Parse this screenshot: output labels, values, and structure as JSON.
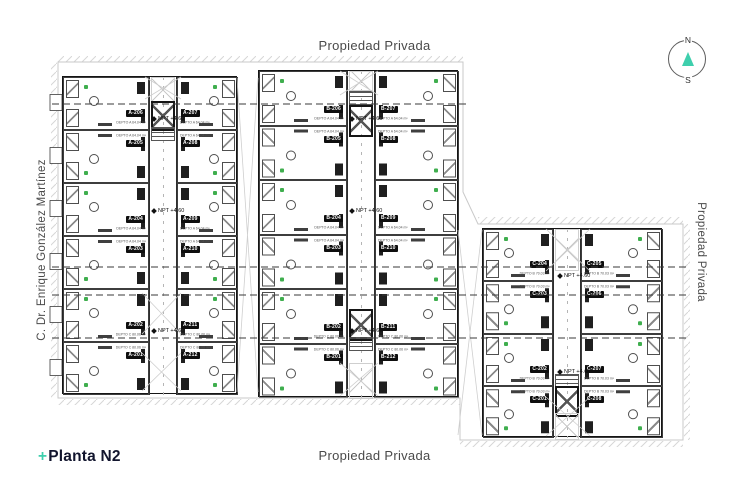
{
  "page": {
    "top_label": "Propiedad Privada",
    "bottom_label": "Propiedad Privada",
    "right_label": "Propiedad Privada",
    "left_label": "C. Dr. Enrique González Martínez",
    "title_plus": "+",
    "title": "Planta N2",
    "accent_color": "#3ECFAD",
    "title_color": "#12152E",
    "label_color": "#4A4A4A",
    "plan_line_color": "#2E2E2E",
    "vegetation_color": "#3FAE4E"
  },
  "compass": {
    "north": "N",
    "south": "S",
    "needle_color": "#3ECFAD"
  },
  "plan": {
    "level_label": "NPT +4.60",
    "blocks": [
      {
        "id": "a",
        "left_units": [
          {
            "label": "A-206",
            "area": "DEPTO A 64.04 m²"
          },
          {
            "label": "A-205",
            "area": "DEPTO A 64.04 m²"
          },
          {
            "label": "A-204",
            "area": "DEPTO A 64.04 m²"
          },
          {
            "label": "A-203",
            "area": "DEPTO A 64.04 m²"
          },
          {
            "label": "A-202",
            "area": "DEPTO C 80.06 m²"
          },
          {
            "label": "A-201",
            "area": "DEPTO C 80.06 m²"
          }
        ],
        "right_units": [
          {
            "label": "A-207",
            "area": "DEPTO A 64.04 m²"
          },
          {
            "label": "A-208",
            "area": "DEPTO A 64.04 m²"
          },
          {
            "label": "A-209",
            "area": "DEPTO A 64.04 m²"
          },
          {
            "label": "A-210",
            "area": "DEPTO A 64.04 m²"
          },
          {
            "label": "A-211",
            "area": "DEPTO C 80.06 m²"
          },
          {
            "label": "A-212",
            "area": "DEPTO C 80.06 m²"
          }
        ]
      },
      {
        "id": "b",
        "left_units": [
          {
            "label": "B-206",
            "area": "DEPTO A 64.04 m²"
          },
          {
            "label": "B-205",
            "area": "DEPTO A 64.04 m²"
          },
          {
            "label": "B-204",
            "area": "DEPTO A 64.04 m²"
          },
          {
            "label": "B-203",
            "area": "DEPTO A 64.04 m²"
          },
          {
            "label": "B-202",
            "area": "DEPTO C 80.06 m²"
          },
          {
            "label": "B-201",
            "area": "DEPTO C 80.06 m²"
          }
        ],
        "right_units": [
          {
            "label": "B-207",
            "area": "DEPTO A 64.04 m²"
          },
          {
            "label": "B-208",
            "area": "DEPTO A 64.04 m²"
          },
          {
            "label": "B-209",
            "area": "DEPTO A 64.04 m²"
          },
          {
            "label": "B-210",
            "area": "DEPTO A 64.04 m²"
          },
          {
            "label": "B-211",
            "area": "DEPTO C 80.06 m²"
          },
          {
            "label": "B-212",
            "area": "DEPTO C 80.06 m²"
          }
        ]
      },
      {
        "id": "c",
        "left_units": [
          {
            "label": "C-204",
            "area": "DEPTO B 70.03 m²"
          },
          {
            "label": "C-203",
            "area": "DEPTO B 70.03 m²"
          },
          {
            "label": "C-202",
            "area": "DEPTO B 70.03 m²"
          },
          {
            "label": "C-201",
            "area": "DEPTO B 70.03 m²"
          }
        ],
        "right_units": [
          {
            "label": "C-205",
            "area": "DEPTO B 70.03 m²"
          },
          {
            "label": "C-206",
            "area": "DEPTO B 70.03 m²"
          },
          {
            "label": "C-207",
            "area": "DEPTO B 70.03 m²"
          },
          {
            "label": "C-208",
            "area": "DEPTO B 70.03 m²"
          }
        ]
      }
    ]
  }
}
